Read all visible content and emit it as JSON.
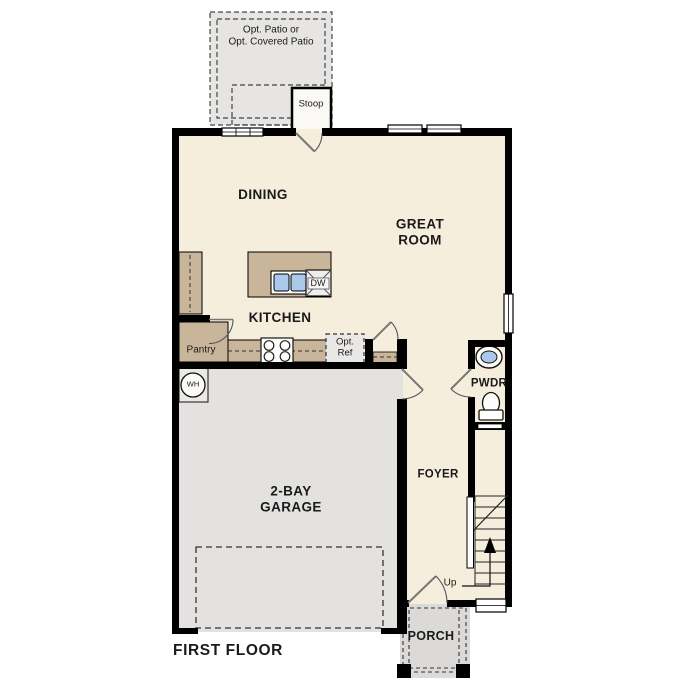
{
  "title": "FIRST FLOOR",
  "plan_type": "residential-first-floor-plan",
  "rooms": {
    "dining": "DINING",
    "great_room": [
      "GREAT",
      "ROOM"
    ],
    "kitchen": "KITCHEN",
    "garage": [
      "2-BAY",
      "GARAGE"
    ],
    "pwdr": "PWDR",
    "foyer": "FOYER",
    "porch": "PORCH"
  },
  "labels": {
    "patio": [
      "Opt. Patio or",
      "Opt. Covered Patio"
    ],
    "stoop": "Stoop",
    "pantry": "Pantry",
    "opt_ref": [
      "Opt.",
      "Ref"
    ],
    "water_heater": "WH",
    "dishwasher": "DW",
    "up": "Up"
  },
  "colors": {
    "wall": "#000000",
    "interior": "#f6eedd",
    "cabinet_tan": "#c9b59a",
    "garage_gray": "#e3e2e0",
    "porch_gray": "#dbdad8",
    "patio_gray": "#e6e5e3",
    "fixture_blue": "#a9c8ea",
    "background": "#ffffff"
  }
}
